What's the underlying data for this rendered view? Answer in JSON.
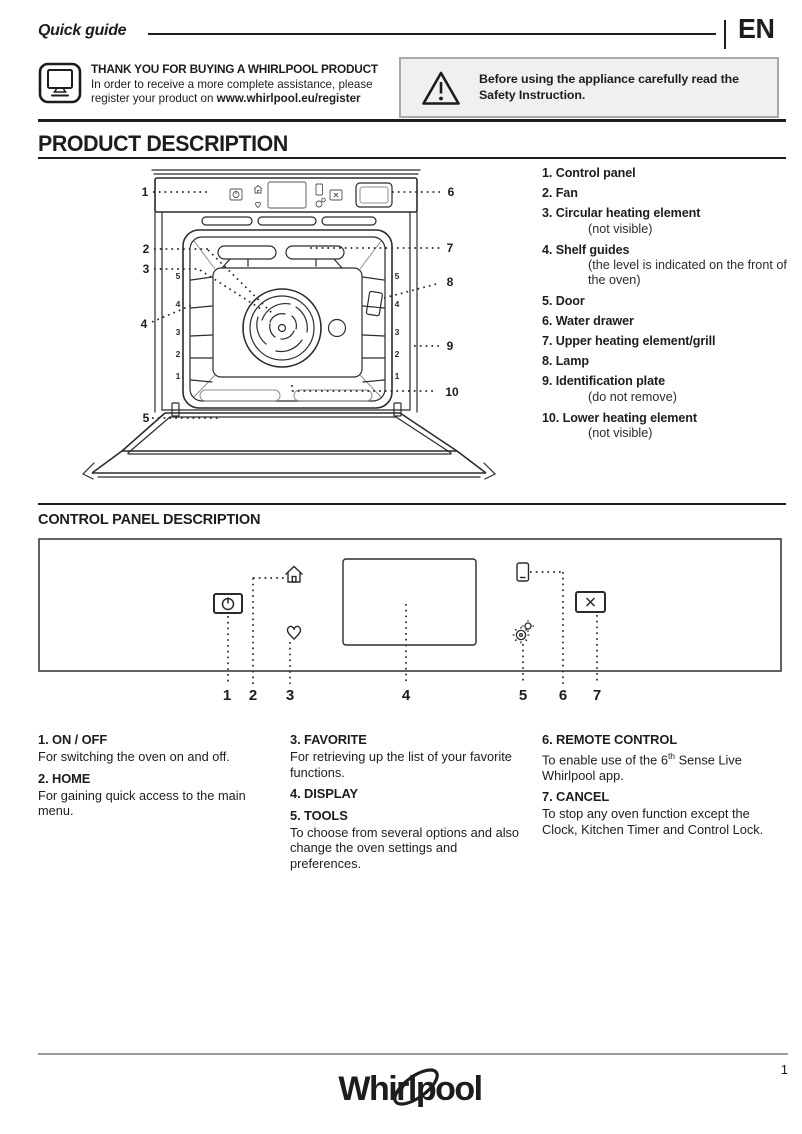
{
  "header": {
    "doc_title": "Quick guide",
    "language": "EN"
  },
  "intro": {
    "title": "THANK YOU FOR BUYING A WHIRLPOOL PRODUCT",
    "body_before_link": "In order to receive a more complete assistance, please register your product on ",
    "link": "www.whirlpool.eu/register"
  },
  "warning": {
    "text": "Before using the appliance carefully read the Safety Instruction."
  },
  "product_description": {
    "heading": "PRODUCT DESCRIPTION",
    "items": [
      {
        "num": "1.",
        "label": "Control panel"
      },
      {
        "num": "2.",
        "label": "Fan"
      },
      {
        "num": "3.",
        "label": "Circular heating element",
        "note": "(not visible)"
      },
      {
        "num": "4.",
        "label": "Shelf guides",
        "note": "(the level is indicated on the front of the oven)"
      },
      {
        "num": "5.",
        "label": "Door"
      },
      {
        "num": "6.",
        "label": "Water drawer"
      },
      {
        "num": "7.",
        "label": "Upper heating element/grill"
      },
      {
        "num": "8.",
        "label": "Lamp"
      },
      {
        "num": "9.",
        "label": "Identification plate",
        "note": "(do not remove)"
      },
      {
        "num": "10.",
        "label": "Lower heating element",
        "note": "(not visible)"
      }
    ],
    "diagram": {
      "labels": [
        "1",
        "2",
        "3",
        "4",
        "5",
        "6",
        "7",
        "8",
        "9",
        "10"
      ],
      "shelf_levels": [
        "5",
        "4",
        "3",
        "2",
        "1"
      ]
    }
  },
  "control_panel": {
    "heading": "CONTROL PANEL DESCRIPTION",
    "numbers": [
      "1",
      "2",
      "3",
      "4",
      "5",
      "6",
      "7"
    ],
    "functions": [
      {
        "name": "1. ON / OFF",
        "desc": "For switching the oven on and off."
      },
      {
        "name": "2. HOME",
        "desc": "For gaining quick access to the main menu."
      },
      {
        "name": "3. FAVORITE",
        "desc": "For retrieving up the list of your favorite functions."
      },
      {
        "name": "4. DISPLAY",
        "desc": ""
      },
      {
        "name": "5. TOOLS",
        "desc": "To choose from several options and also change the oven settings and preferences."
      },
      {
        "name": "6. REMOTE CONTROL",
        "desc_before_sup": "To enable use of the 6",
        "desc_sup": "th",
        "desc_after_sup": " Sense Live Whirlpool app."
      },
      {
        "name": "7. CANCEL",
        "desc": "To stop any oven function except the Clock, Kitchen Timer and Control Lock."
      }
    ]
  },
  "footer": {
    "brand": "Whirlpool",
    "page_number": "1"
  }
}
